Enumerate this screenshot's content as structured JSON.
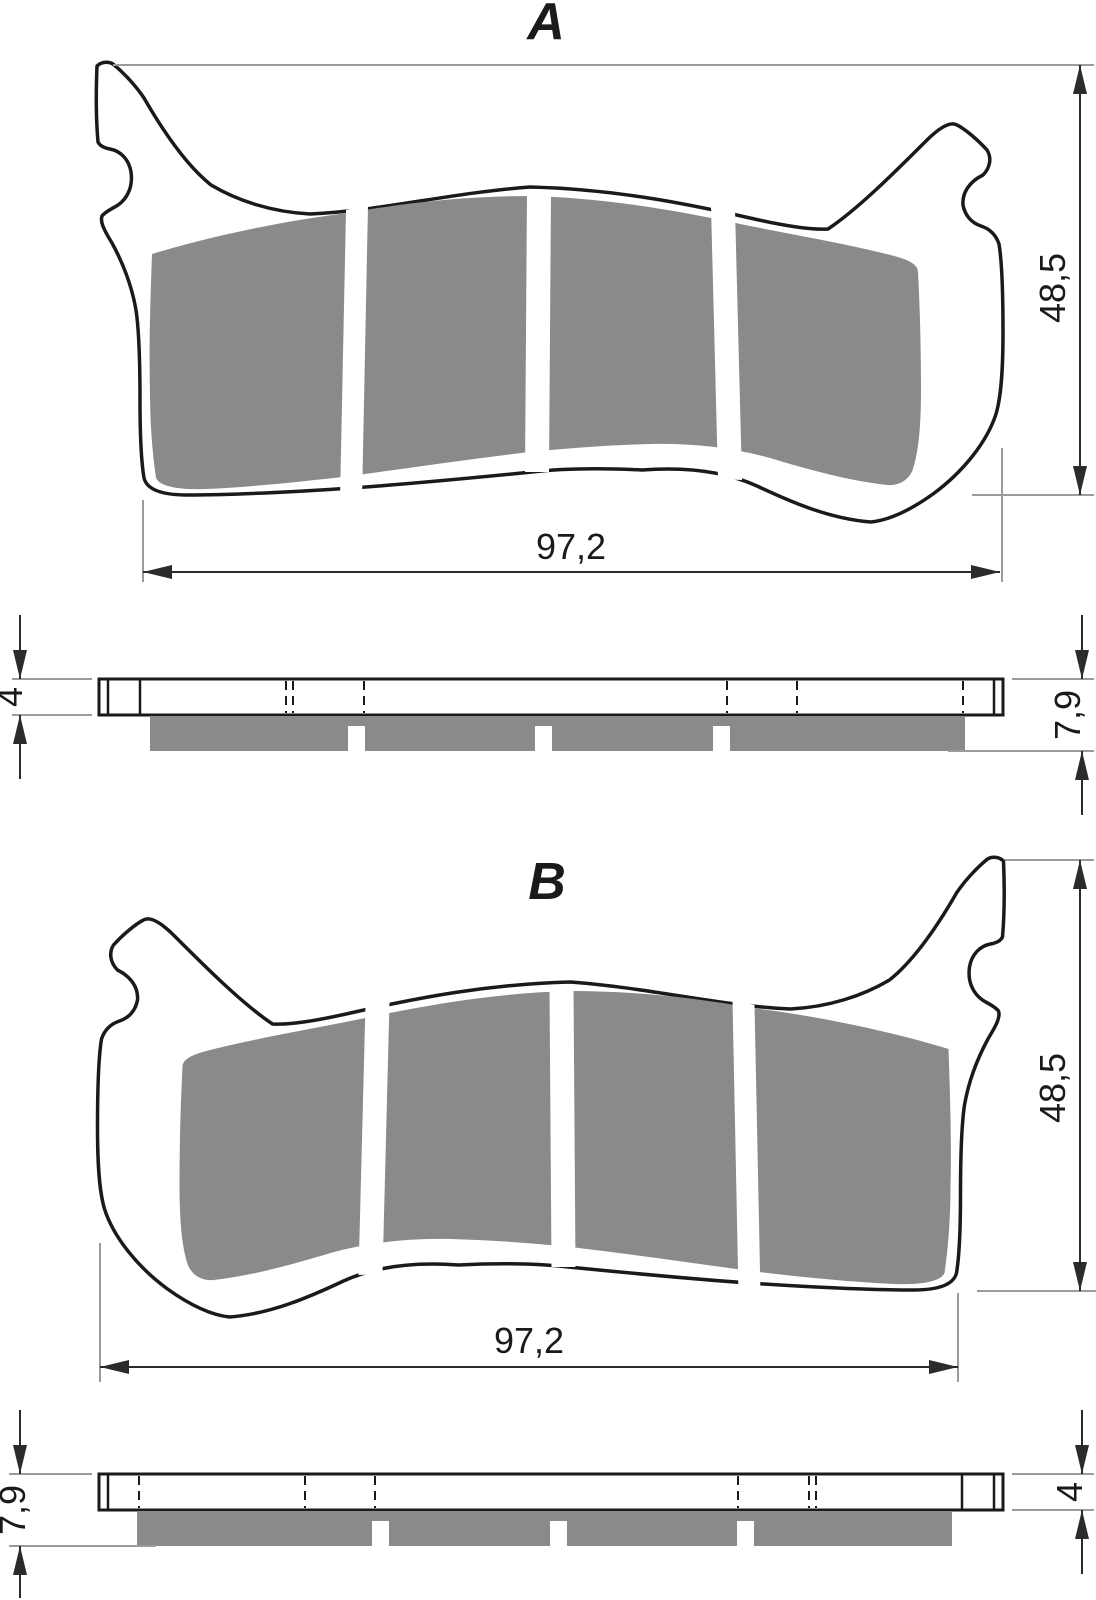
{
  "drawing": {
    "views": {
      "top_a": {
        "label": "A",
        "width": "97,2",
        "height": "48,5"
      },
      "side_a": {
        "backing_thickness": "4",
        "total_thickness": "7,9"
      },
      "top_b": {
        "label": "B",
        "width": "97,2",
        "height": "48,5"
      },
      "side_b": {
        "backing_thickness": "4",
        "total_thickness": "7,9"
      }
    },
    "colors": {
      "friction": "#8a8a8a",
      "outline": "#1a1a1a",
      "dimension": "#2b2b2b",
      "extension": "#9b9b9b",
      "background": "#ffffff"
    }
  }
}
